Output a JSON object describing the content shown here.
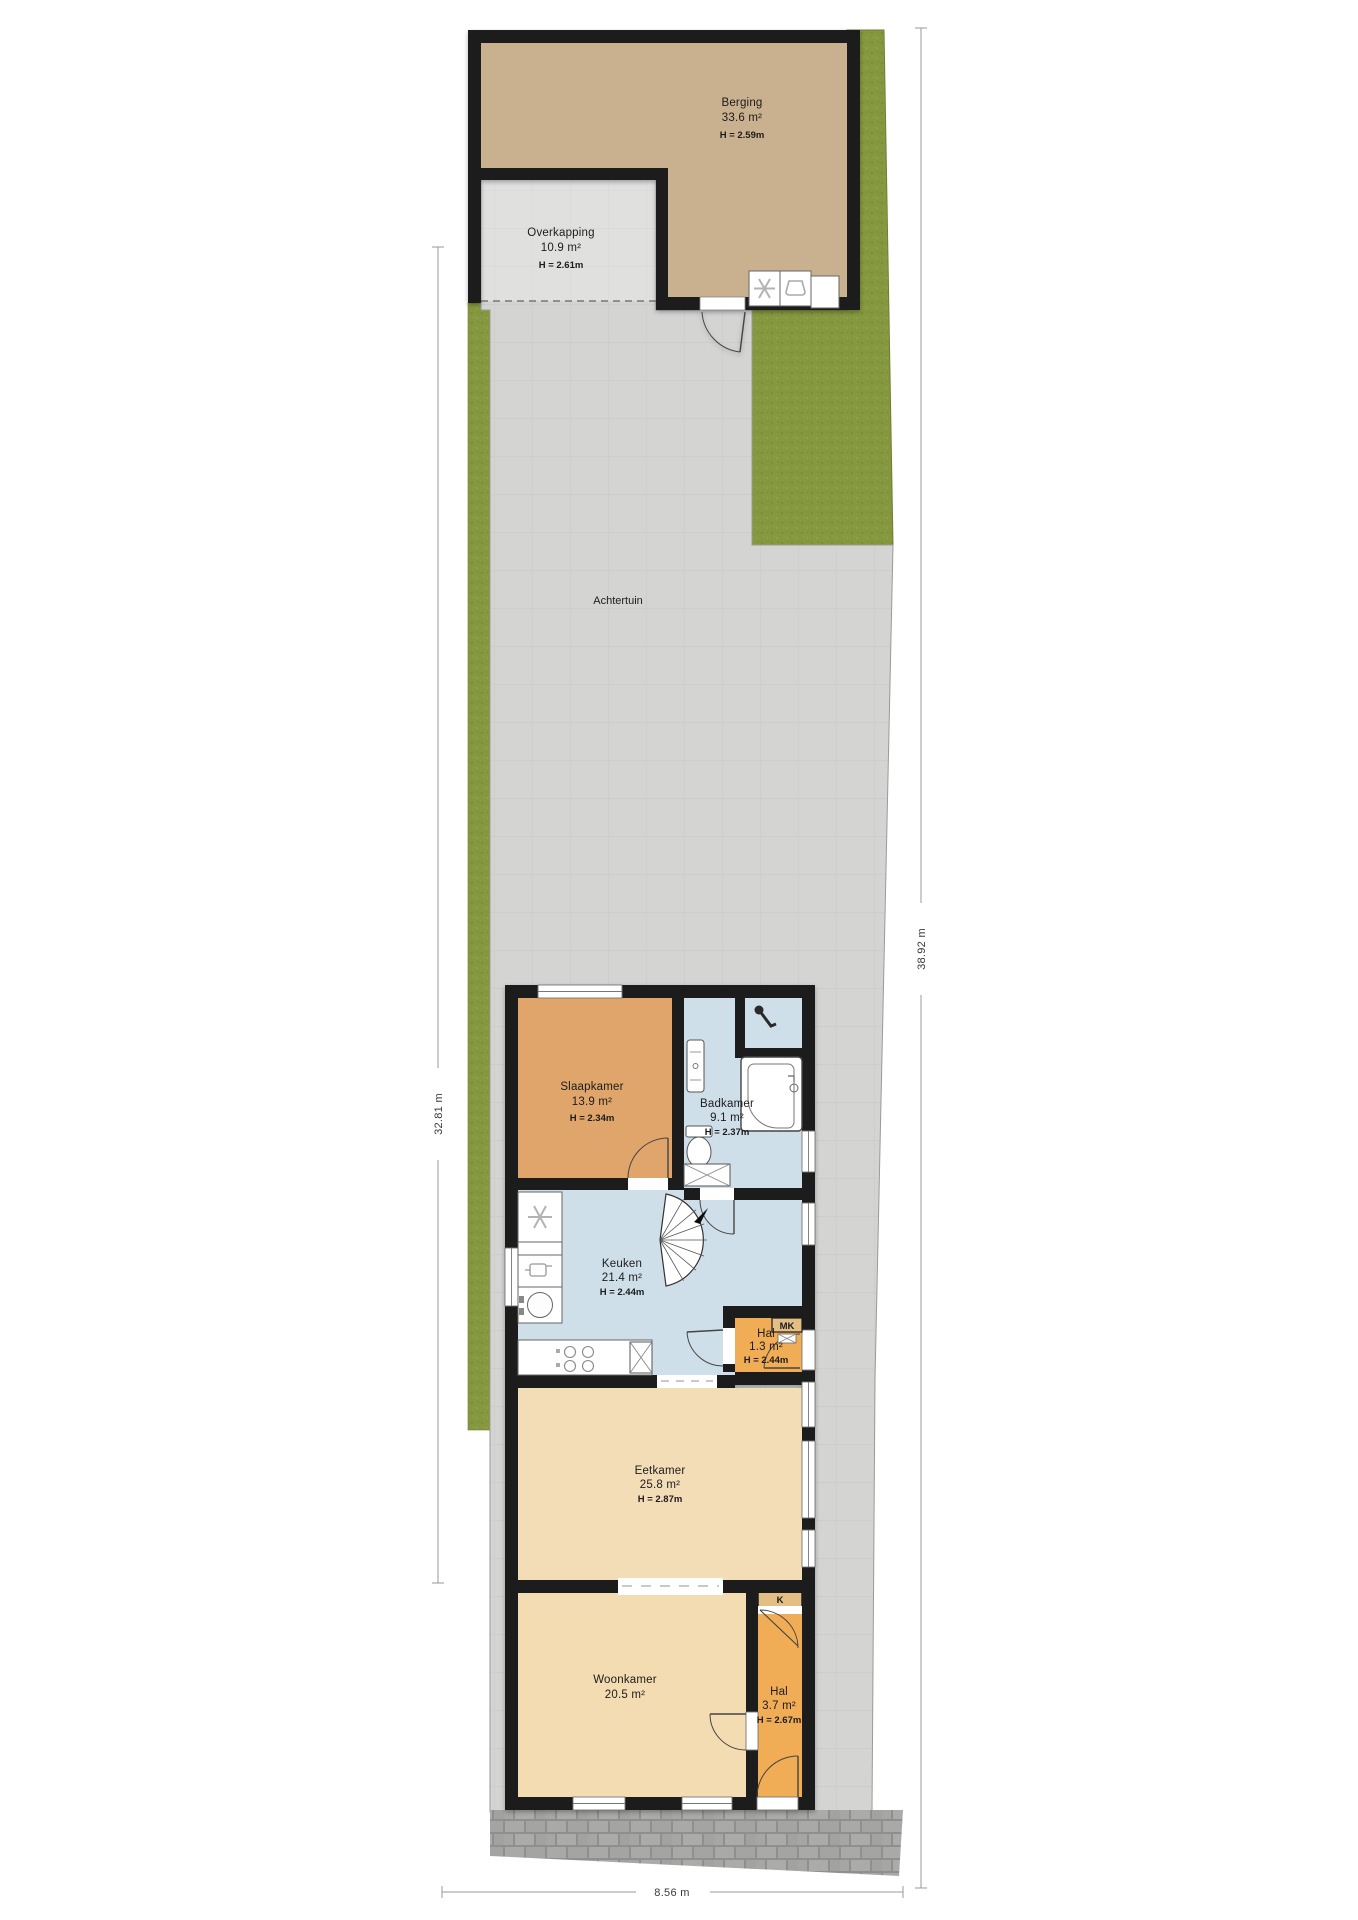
{
  "plan": {
    "type_label": "Achtertuin",
    "rooms": {
      "berging": {
        "name": "Berging",
        "area": "33.6 m²",
        "height": "H = 2.59m"
      },
      "overkapping": {
        "name": "Overkapping",
        "area": "10.9 m²",
        "height": "H = 2.61m"
      },
      "achtertuin": {
        "name": "Achtertuin"
      },
      "slaapkamer": {
        "name": "Slaapkamer",
        "area": "13.9 m²",
        "height": "H = 2.34m"
      },
      "badkamer": {
        "name": "Badkamer",
        "area": "9.1 m²",
        "height": "H = 2.37m"
      },
      "keuken": {
        "name": "Keuken",
        "area": "21.4 m²",
        "height": "H = 2.44m"
      },
      "hal_achter": {
        "name": "Hal",
        "area": "1.3 m²",
        "height": "H = 2.44m"
      },
      "eetkamer": {
        "name": "Eetkamer",
        "area": "25.8 m²",
        "height": "H = 2.87m"
      },
      "woonkamer": {
        "name": "Woonkamer",
        "area": "20.5 m²"
      },
      "hal_voor": {
        "name": "Hal",
        "area": "3.7 m²",
        "height": "H = 2.67m"
      }
    },
    "closets": {
      "meterkast_label": "MK",
      "kast_label": "K"
    },
    "dimensions": {
      "left": "32.81 m",
      "right": "38.92 m",
      "bottom": "8.56 m"
    },
    "colors": {
      "wall": "#1a1a1a",
      "berging_floor": "#c9b08f",
      "terrace": "#d4d4d3",
      "grass": "#85983f",
      "bedroom": "#e0a56a",
      "bathroom": "#cfdfe9",
      "kitchen": "#cfdfe9",
      "hall": "#f0ad55",
      "dining": "#f3ddb7",
      "living": "#f3dcb2",
      "closet": "#e5be86",
      "brick": "#a9a9a7"
    }
  }
}
